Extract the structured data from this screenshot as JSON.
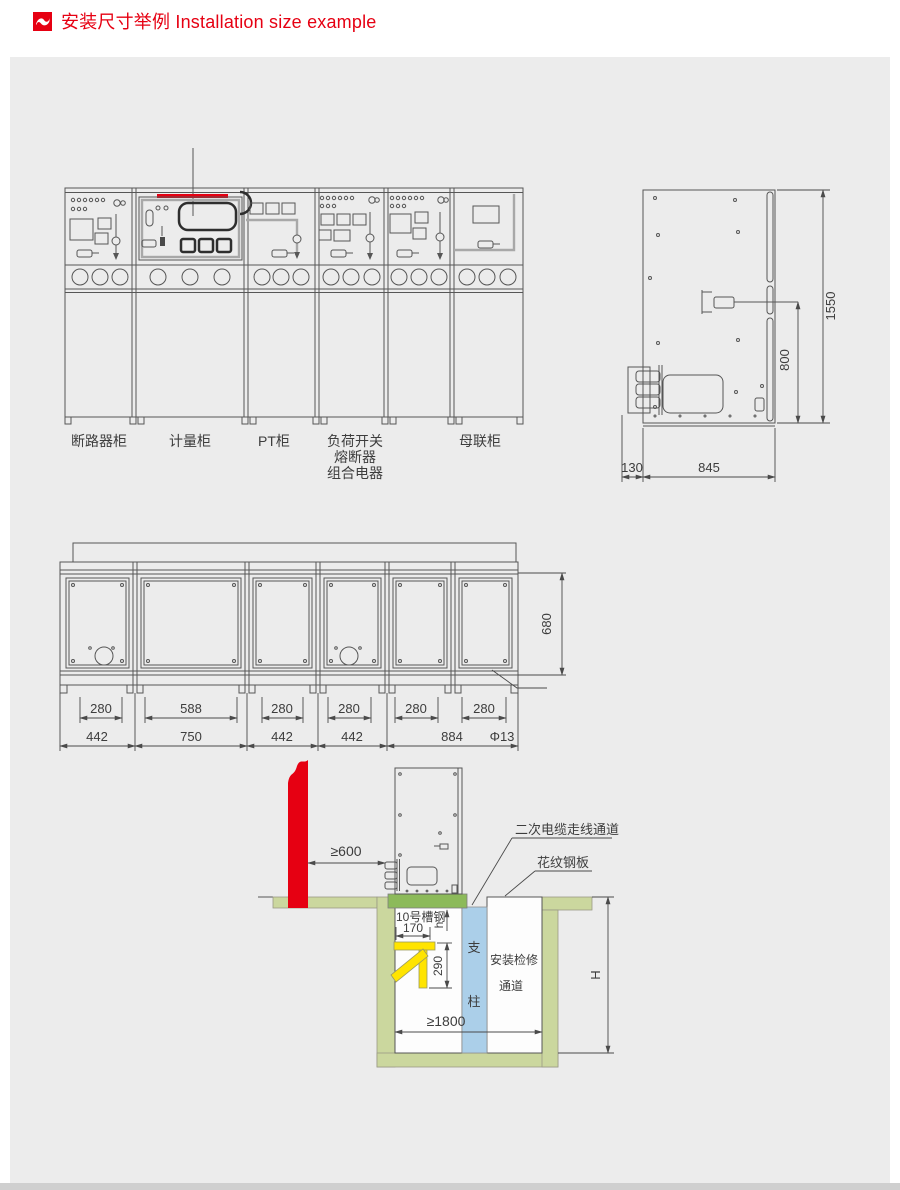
{
  "header": {
    "title": "安装尺寸举例 Installation size example"
  },
  "front_view": {
    "cabinets": [
      {
        "label": "断路器柜"
      },
      {
        "label": "计量柜"
      },
      {
        "label": "PT柜"
      },
      {
        "label": "负荷开关",
        "label_line2": "熔断器",
        "label_line3": "组合电器"
      },
      {
        "label": "母联柜"
      }
    ]
  },
  "side_view": {
    "dim_height_total": "1550",
    "dim_height_handle": "800",
    "dim_depth_bushing": "130",
    "dim_depth_body": "845"
  },
  "plan_view": {
    "dim_row_top": [
      "280",
      "588",
      "280",
      "280",
      "280",
      "280"
    ],
    "dim_row_bottom": [
      "442",
      "750",
      "442",
      "442",
      "884"
    ],
    "dim_hole_dia": "Φ13",
    "dim_depth": "680"
  },
  "section_view": {
    "dim_wall_clearance": "≥600",
    "dim_bracket_width": "170",
    "dim_bracket_height": "290",
    "dim_trench_width": "≥1800",
    "dim_trench_depth": "H",
    "dim_channel_height": "h",
    "label_cable_channel": "二次电缆走线通道",
    "label_checkered_plate": "花纹钢板",
    "label_channel_steel": "10号槽钢",
    "label_support_top": "支",
    "label_support_bottom": "柱",
    "label_access_line1": "安装检修",
    "label_access_line2": "通道"
  },
  "colors": {
    "accent_red": "#e60012",
    "channel_steel_green": "#8cba5a",
    "concrete_olive": "#cbd79e",
    "support_column_blue": "#abcfe9",
    "bracket_yellow": "#ffe400",
    "panel_background": "#ececec",
    "drawing_line": "#4a4a4a"
  }
}
